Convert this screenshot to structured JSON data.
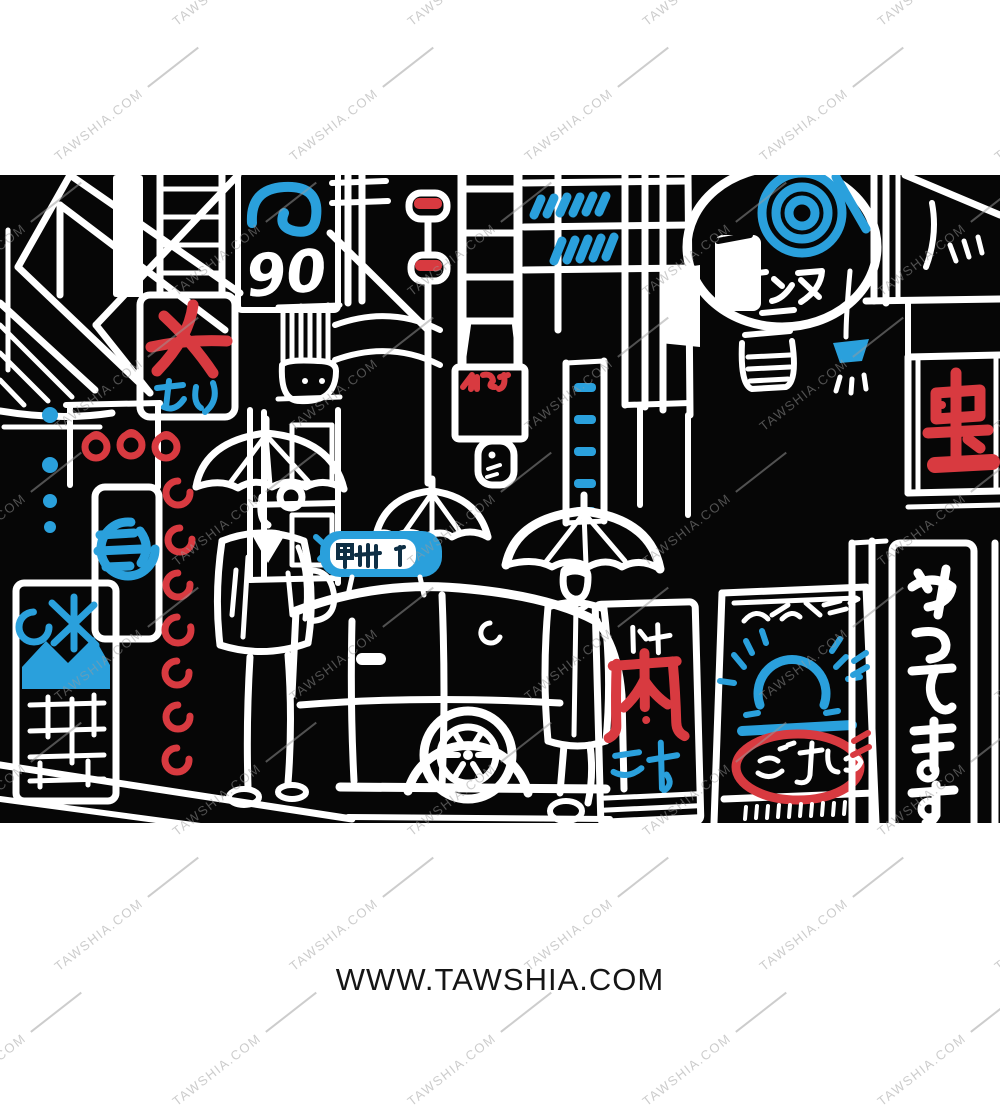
{
  "page": {
    "background_color": "#ffffff"
  },
  "watermark": {
    "text": "TAWSHIA.COM",
    "color": "#9b9b9b"
  },
  "footer": {
    "text": "WWW.TAWSHIA.COM",
    "color": "#151515"
  },
  "artwork": {
    "scene": "Hand-drawn line-art of a rainy Tokyo back street at night: two pedestrians with umbrellas beside a taxi, surrounded by doodled neon shop signs",
    "style": "white doodle outlines on black with red and blue accents",
    "background_color": "#060606",
    "line_color": "#ffffff",
    "accent_red": "#d83a40",
    "accent_blue": "#2aa0dc",
    "signs": {
      "number_sign": "90",
      "kanji_sign_woman": "女",
      "kanji_sign_woman_sub": "あり",
      "oval_sign_katakana": "アンヌ",
      "taxi_roof_sign": "甲州",
      "meat_sign": "肉",
      "meat_sign_sub": "汁",
      "vertical_banner": "やってます",
      "red_pillar_sign": "虫",
      "board_sign_text": "ごちゃ"
    }
  }
}
